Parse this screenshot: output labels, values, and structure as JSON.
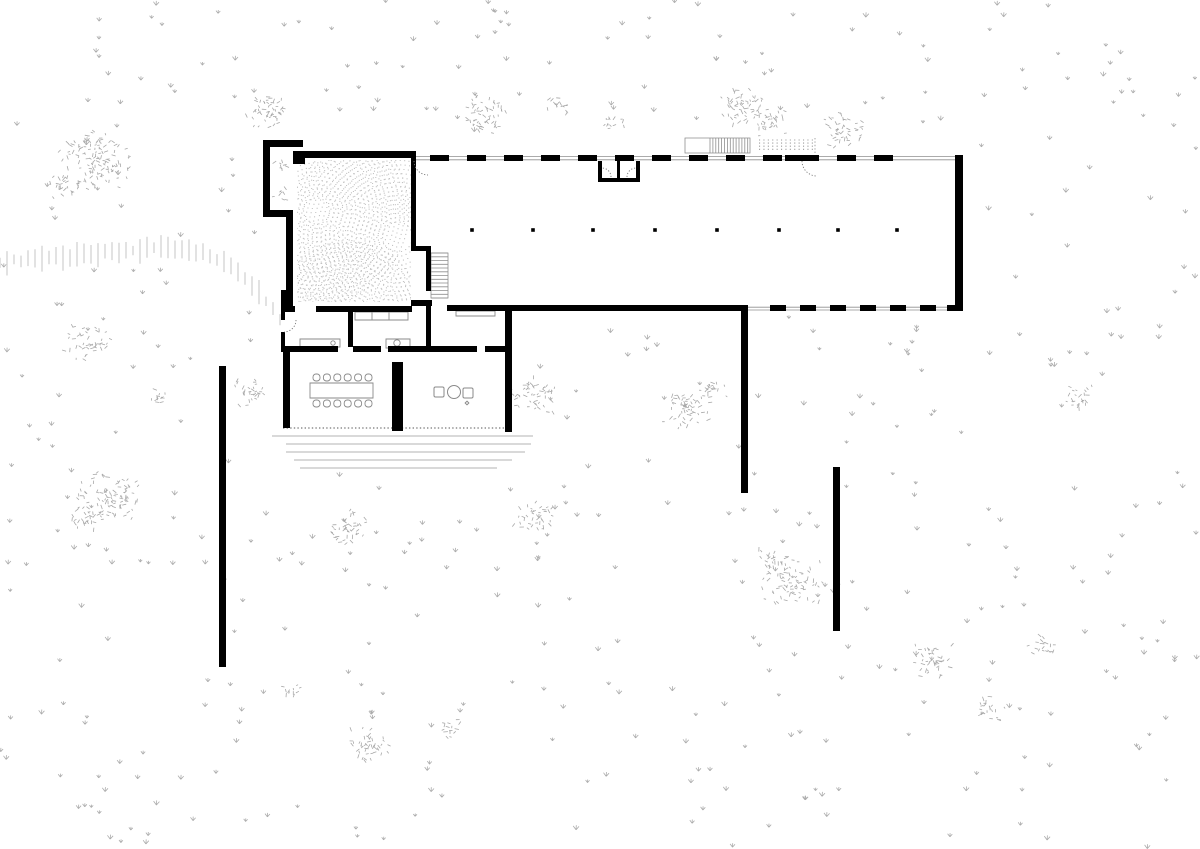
{
  "meta": {
    "drawing_type": "architectural-site-and-floor-plan",
    "background": "#ffffff",
    "ink": "#000000",
    "thin_line_color": "#8f8f8f",
    "vegetation_color": "#acacac",
    "canvas": {
      "w": 1200,
      "h": 849
    }
  },
  "plan": {
    "solid_walls": [
      [
        263,
        140,
        40,
        7
      ],
      [
        263,
        140,
        7,
        77
      ],
      [
        266,
        210,
        27,
        7
      ],
      [
        293,
        151,
        123,
        7
      ],
      [
        293,
        152,
        12,
        12
      ],
      [
        286,
        210,
        7,
        98
      ],
      [
        411,
        158,
        5,
        90
      ],
      [
        281,
        290,
        12,
        21
      ],
      [
        281,
        306,
        14,
        6
      ],
      [
        316,
        306,
        96,
        6
      ],
      [
        281,
        311,
        4,
        9
      ],
      [
        281,
        332,
        4,
        20
      ],
      [
        348,
        306,
        5,
        41
      ],
      [
        285,
        346,
        53,
        6
      ],
      [
        353,
        346,
        28,
        6
      ],
      [
        388,
        346,
        89,
        6
      ],
      [
        485,
        346,
        27,
        6
      ],
      [
        283,
        352,
        7,
        76
      ],
      [
        392,
        362,
        11,
        69
      ],
      [
        505,
        311,
        7,
        121
      ],
      [
        411,
        246,
        20,
        5
      ],
      [
        426,
        251,
        5,
        40
      ],
      [
        411,
        300,
        21,
        6
      ],
      [
        426,
        306,
        5,
        40
      ],
      [
        447,
        305,
        301,
        6
      ],
      [
        955,
        155,
        8,
        156
      ],
      [
        598,
        161,
        4,
        21
      ],
      [
        636,
        161,
        4,
        21
      ],
      [
        598,
        178,
        42,
        4
      ],
      [
        617,
        161,
        3,
        17
      ],
      [
        785,
        155,
        25,
        6
      ],
      [
        219,
        366,
        7,
        301
      ],
      [
        741,
        305,
        7,
        188
      ],
      [
        833,
        467,
        7,
        164
      ]
    ],
    "glazing_lines": [
      [
        416,
        156.5,
        963,
        156.5
      ],
      [
        416,
        159.8,
        963,
        159.8
      ],
      [
        748,
        307.2,
        963,
        307.2
      ],
      [
        748,
        310,
        963,
        310
      ]
    ],
    "top_dashes": {
      "x0": 430,
      "x1": 898,
      "y": 155,
      "h": 6,
      "dash": 19,
      "period": 37
    },
    "bottom_dashes": {
      "x0": 770,
      "x1": 946,
      "y": 305,
      "h": 6,
      "dash": 16,
      "period": 30,
      "extra": [
        947,
        305,
        9,
        6
      ]
    },
    "columns": {
      "size": 3.6,
      "y": 230,
      "xs": [
        472,
        533,
        593,
        655,
        717,
        779,
        838,
        897
      ]
    },
    "stair": {
      "x0": 431,
      "x1": 448,
      "y0": 253,
      "y1": 298,
      "treads": 13
    },
    "ext_stair": {
      "frame": [
        685,
        138,
        65,
        15
      ],
      "hatch": {
        "x0": 710,
        "x1": 750,
        "step": 2.9,
        "y0": 138,
        "y1": 153
      }
    },
    "dot_grid": {
      "x0": 759,
      "x1": 813,
      "y0": 140,
      "y1": 152,
      "sx": 4.4,
      "sy": 3.1,
      "size": 1.1,
      "edge": [
        815,
        138,
        815,
        153
      ]
    },
    "doors": [
      {
        "d": "M414,161 A14,14 0 0 0 428,175"
      },
      {
        "d": "M802,161 A15,15 0 0 0 817,176"
      },
      {
        "d": "M296,320 A12,12 0 0 1 284,332"
      },
      {
        "d": "M611,177 A9,9 0 0 0 602,168"
      },
      {
        "d": "M627,177 A9,9 0 0 1 636,168"
      }
    ],
    "counters": {
      "rects": [
        [
          300,
          339,
          40,
          8
        ],
        [
          355,
          312,
          53,
          8
        ],
        [
          386,
          339,
          24,
          9
        ],
        [
          456,
          311,
          39,
          5
        ]
      ],
      "dividers": [
        [
          372,
          312,
          372,
          320
        ],
        [
          389,
          312,
          389,
          320
        ]
      ],
      "circles": [
        [
          333,
          343,
          2.2
        ],
        [
          397,
          343,
          3.2
        ]
      ]
    },
    "kitchen_island": {
      "squares": [
        [
          434,
          387,
          10,
          10
        ],
        [
          463,
          388,
          10,
          10
        ]
      ],
      "circle": [
        454,
        392,
        6.5
      ],
      "dot": [
        467,
        403,
        1.3
      ]
    },
    "dining": {
      "table": [
        310,
        383,
        63,
        15
      ],
      "chair": {
        "w": 7,
        "h": 7,
        "n": 6,
        "x0": 313,
        "dx": 10.4,
        "top_y": 374,
        "bot_y": 400
      }
    },
    "terrace_steps": [
      [
        272,
        436,
        533
      ],
      [
        286,
        444,
        531
      ],
      [
        286,
        452,
        525
      ],
      [
        294,
        460,
        512
      ],
      [
        300,
        468,
        497
      ]
    ],
    "glass_edge": [
      283,
      428,
      505,
      428
    ],
    "stipple": {
      "clip": [
        297,
        160,
        114,
        142
      ],
      "ring_step": 4.4,
      "dot_step": 4.4,
      "size": 1.1,
      "color": "#c4c4c4",
      "fans": [
        [
          316,
          211,
          13,
          95
        ],
        [
          397,
          237,
          15,
          115
        ],
        [
          348,
          316,
          12,
          75
        ]
      ]
    }
  },
  "vegetation": {
    "color": "#acacac",
    "clusters": [
      [
        95,
        160,
        40
      ],
      [
        62,
        185,
        18
      ],
      [
        268,
        112,
        26
      ],
      [
        482,
        113,
        27
      ],
      [
        613,
        124,
        13
      ],
      [
        560,
        105,
        14
      ],
      [
        745,
        107,
        28
      ],
      [
        772,
        122,
        20
      ],
      [
        845,
        130,
        24
      ],
      [
        88,
        344,
        24
      ],
      [
        158,
        398,
        13
      ],
      [
        250,
        392,
        20
      ],
      [
        532,
        394,
        26
      ],
      [
        688,
        408,
        28
      ],
      [
        712,
        390,
        16
      ],
      [
        108,
        496,
        36
      ],
      [
        80,
        520,
        18
      ],
      [
        350,
        529,
        24
      ],
      [
        532,
        519,
        22
      ],
      [
        793,
        581,
        32
      ],
      [
        770,
        560,
        16
      ],
      [
        938,
        662,
        24
      ],
      [
        993,
        710,
        18
      ],
      [
        1042,
        645,
        16
      ],
      [
        1078,
        397,
        18
      ],
      [
        370,
        744,
        24
      ],
      [
        452,
        729,
        14
      ],
      [
        290,
        691,
        12
      ],
      [
        281,
        166,
        9
      ],
      [
        280,
        194,
        9
      ]
    ],
    "tufts": {
      "seed": 1234,
      "target": 450,
      "max_tries": 1600,
      "exclude": [
        [
          258,
          135,
          710,
          180
        ],
        [
          258,
          315,
          280,
          158
        ],
        [
          683,
          132,
          140,
          24
        ]
      ]
    },
    "hachure": {
      "color": "#c6c6c6",
      "points": [
        [
          0,
          262
        ],
        [
          60,
          257
        ],
        [
          120,
          251
        ],
        [
          160,
          248
        ],
        [
          200,
          252
        ],
        [
          230,
          263
        ],
        [
          255,
          287
        ],
        [
          272,
          308
        ],
        [
          286,
          327
        ]
      ],
      "spacing": 7,
      "min_len": 9,
      "max_len": 26
    }
  }
}
